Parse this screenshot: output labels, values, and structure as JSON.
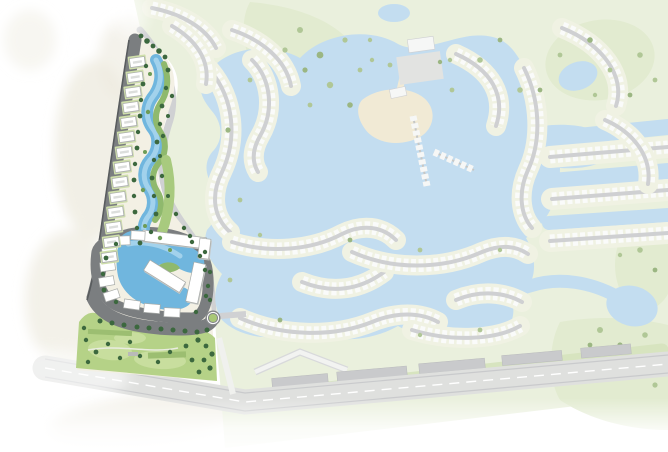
{
  "meta": {
    "title": "Community masterplan map",
    "canvas_width": 668,
    "canvas_height": 452
  },
  "map": {
    "style": "illustrated aerial masterplan, watercolor style, no visible text",
    "highlighted_parcel": {
      "position": "left edge, wedge-shaped plot, fully saturated",
      "villa_count": 14,
      "features": [
        "perimeter-road",
        "villa-row",
        "winding-lagoon",
        "apartment-compound-loop",
        "compound-lagoon",
        "community-park",
        "roundabout"
      ]
    },
    "faded_context": {
      "opacity_note": "rest of masterplan washed out",
      "pier_count": 2,
      "features": [
        "central-lake",
        "beach-island",
        "overwater-pier-cabins",
        "canal-villa-streets",
        "golf-greens",
        "clubhouse-plaza",
        "boulevard-building-rows",
        "highway"
      ]
    }
  },
  "colors": {
    "page_bg": "#ffffff",
    "wash": "#ece9dd",
    "f_base": "#eaf0dd",
    "f_patch": "#e2ebd0",
    "f_water": "#c3ddf0",
    "f_shore": "#f0f2e3",
    "f_house": "#fafbfa",
    "f_road": "#cfd0d2",
    "f_tree": "#b0c796",
    "f_tree2": "#9bb682",
    "f_sand": "#f1ead5",
    "f_plaza": "#e2e3e1",
    "f_bldg": "#f6f7f6",
    "f_strip": "#c9cacc",
    "f_hwy": "#dfe0de",
    "f_hwyedge": "#c9cacc",
    "f_bound": "#d0d1d3",
    "f_greenband": "#d7e4bf",
    "p_base": "#f3f0e4",
    "p_road": "#7b7e80",
    "p_roadedge": "#595c5e",
    "p_pad": "#cfdfaa",
    "p_white": "#ffffff",
    "p_shadow": "#c5c7c5",
    "p_bstroke": "#a9aca9",
    "p_binner": "#dcdedc",
    "p_lagoon": "#70b6de",
    "p_lagoon2": "#a2d2ec",
    "p_green": "#8fb96d",
    "p_green2": "#a8ca7e",
    "p_park": "#b5d287",
    "p_park2": "#c8de9e",
    "p_hedge": "#9cbe71",
    "p_tree": "#3c683e",
    "p_tree2": "#6d9c57",
    "p_sand": "#e8dec1"
  }
}
